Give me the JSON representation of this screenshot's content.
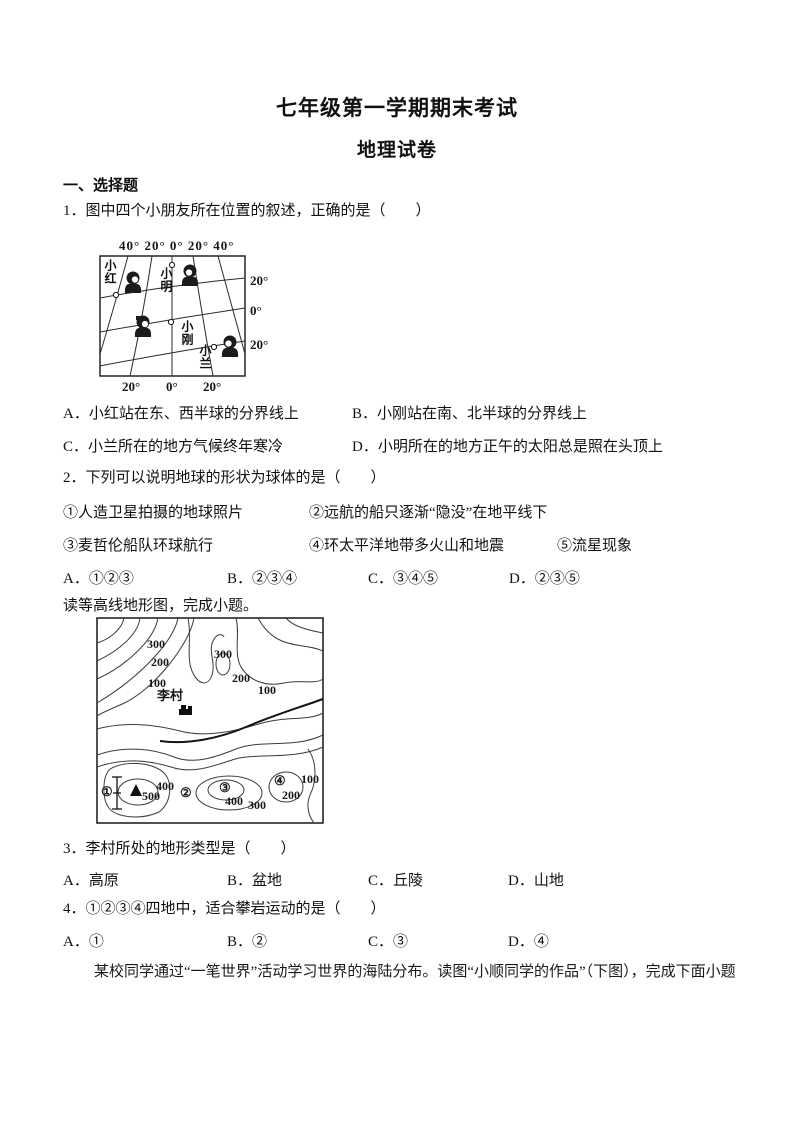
{
  "doc": {
    "title": "七年级第一学期期末考试",
    "subtitle": "地理试卷",
    "section1": "一、选择题"
  },
  "q1": {
    "stem": "1．图中四个小朋友所在位置的叙述，正确的是（　　）",
    "options": [
      "A．小红站在东、西半球的分界线上",
      "B．小刚站在南、北半球的分界线上",
      "C．小兰所在的地方气候终年寒冷",
      "D．小明所在的地方正午的太阳总是照在头顶上"
    ]
  },
  "fig1": {
    "top_axis": "40° 20° 0° 20° 40°",
    "right_labels": [
      "20°",
      "0°",
      "20°"
    ],
    "bottom_labels": [
      "20°",
      "0°",
      "20°"
    ],
    "names": [
      "小红",
      "小明",
      "小刚",
      "小兰"
    ]
  },
  "q2": {
    "stem": "2．下列可以说明地球的形状为球体的是（　　）",
    "items": [
      "①人造卫星拍摄的地球照片",
      "②远航的船只逐渐“隐没”在地平线下",
      "③麦哲伦船队环球航行",
      "④环太平洋地带多火山和地震",
      "⑤流星现象"
    ],
    "options": [
      "A．①②③",
      "B．②③④",
      "C．③④⑤",
      "D．②③⑤"
    ]
  },
  "lead1": "读等高线地形图，完成小题。",
  "fig2": {
    "labels": {
      "l300": "300",
      "l200": "200",
      "l100": "100",
      "r300": "300",
      "r200": "200",
      "r100": "100",
      "village": "李村",
      "p1": "①",
      "p2": "②",
      "p3": "③",
      "p4": "④",
      "e500": "500",
      "e400a": "400",
      "e400b": "400",
      "e300": "300",
      "e200": "200",
      "e100": "100"
    }
  },
  "q3": {
    "stem": "3．李村所处的地形类型是（　　）",
    "options": [
      "A．高原",
      "B．盆地",
      "C．丘陵",
      "D．山地"
    ]
  },
  "q4": {
    "stem": "4．①②③④四地中，适合攀岩运动的是（　　）",
    "options": [
      "A．①",
      "B．②",
      "C．③",
      "D．④"
    ]
  },
  "closing": "某校同学通过“一笔世界”活动学习世界的海陆分布。读图“小顺同学的作品”（下图），完成下面小题"
}
